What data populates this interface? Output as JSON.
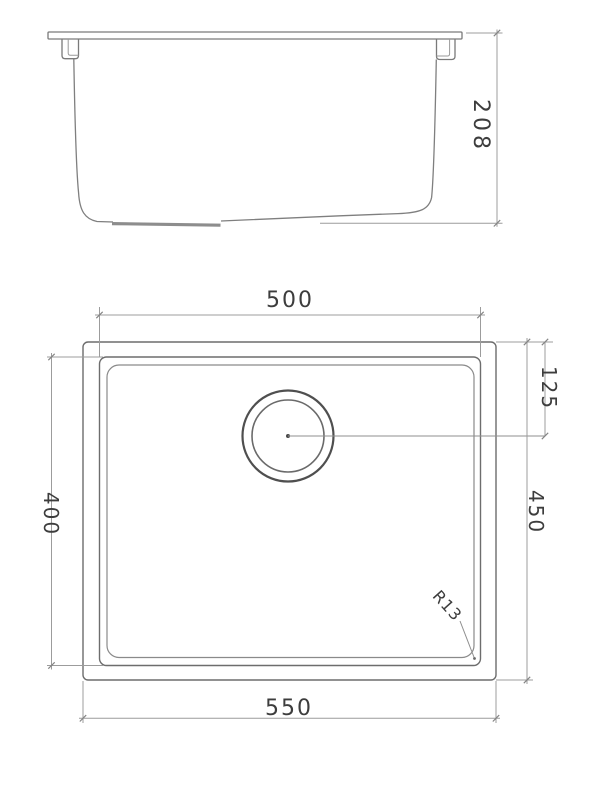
{
  "drawing": {
    "kind": "sink technical drawing",
    "colors": {
      "outline": "#6a6a6a",
      "outline_dark": "#4f4f4f",
      "dimension_line": "#9c9c9c",
      "text": "#3d3d3d",
      "background": "#ffffff"
    }
  },
  "dimensions": {
    "height": "208",
    "bowl_width": "500",
    "drain_offset": "125",
    "bowl_depth": "400",
    "overall_depth": "450",
    "overall_width": "550",
    "corner_radius": "R13"
  }
}
